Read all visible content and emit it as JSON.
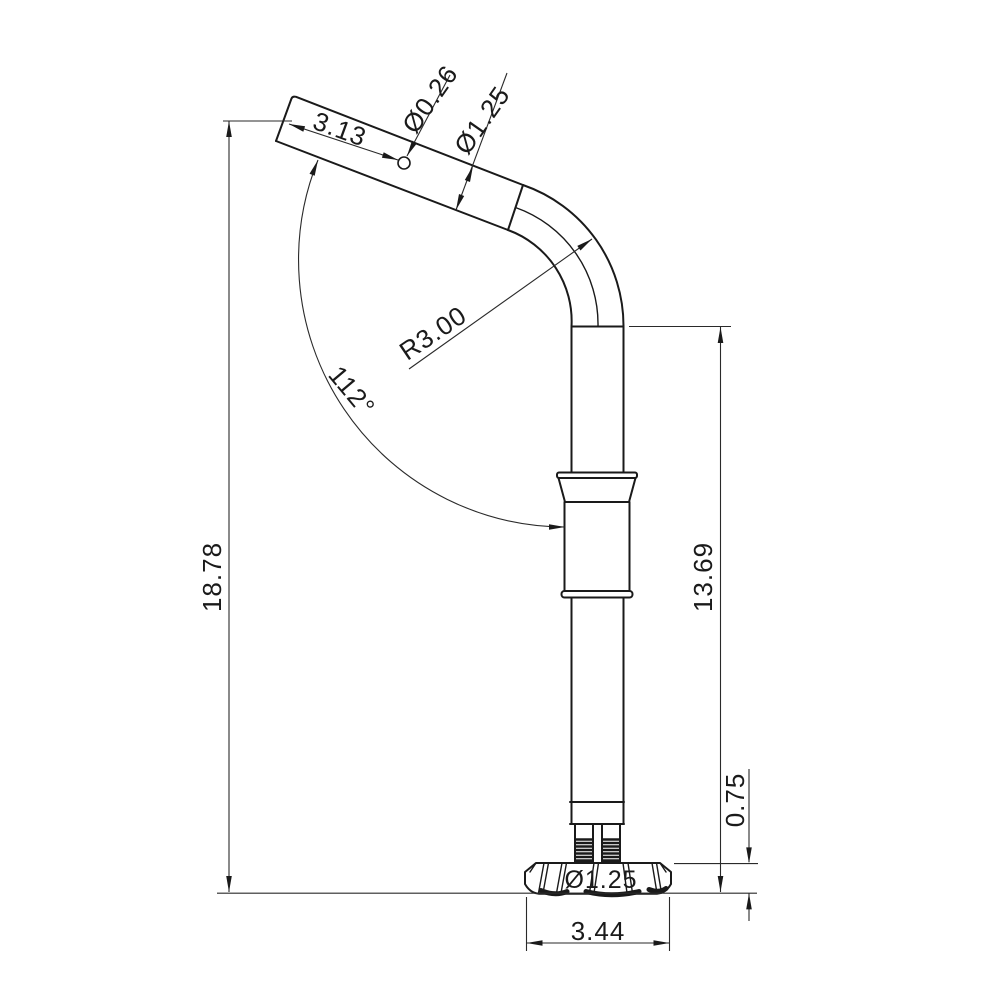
{
  "page": {
    "background": "#ffffff",
    "line_color": "#1a1a1a",
    "description_of_view": "Side view of bent tube with mounting base"
  },
  "drawing": {
    "labels": {
      "arm_length": "3.13",
      "hole_diameter": "Ø0.26",
      "tube_diameter": "Ø1.25",
      "bend_radius": "R3.00",
      "bend_angle": "112°",
      "overall_height": "18.78",
      "post_height": "13.69",
      "base_thickness": "0.75",
      "base_bore_diameter": "Ø1.25",
      "base_width": "3.44"
    }
  }
}
